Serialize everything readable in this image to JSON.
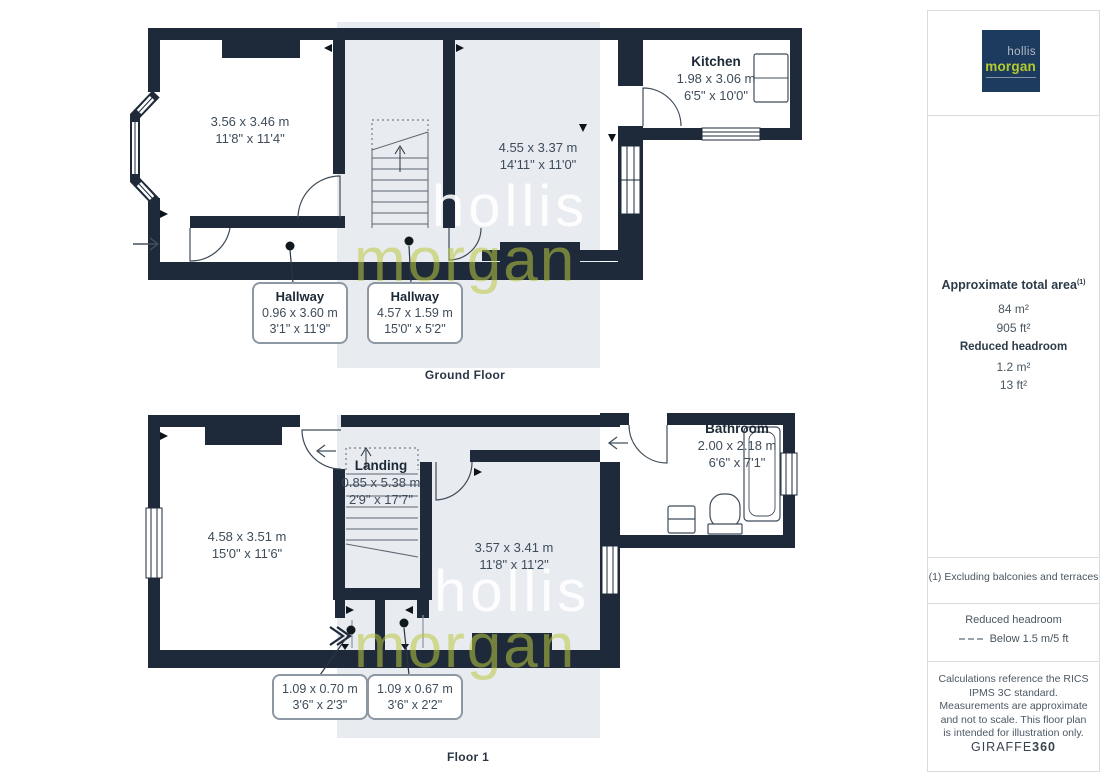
{
  "ground_floor": {
    "label": "Ground Floor",
    "rooms": [
      {
        "dims_m": "3.56 x 3.46 m",
        "dims_ft": "11'8\" x 11'4\""
      },
      {
        "name": "Kitchen",
        "dims_m": "1.98 x 3.06 m",
        "dims_ft": "6'5\" x 10'0\""
      },
      {
        "dims_m": "4.55 x 3.37 m",
        "dims_ft": "14'11\" x 11'0\""
      }
    ],
    "callouts": [
      {
        "name": "Hallway",
        "dims_m": "0.96 x 3.60 m",
        "dims_ft": "3'1\" x 11'9\""
      },
      {
        "name": "Hallway",
        "dims_m": "4.57 x 1.59 m",
        "dims_ft": "15'0\" x 5'2\""
      }
    ]
  },
  "floor_1": {
    "label": "Floor 1",
    "rooms": [
      {
        "dims_m": "4.58 x 3.51 m",
        "dims_ft": "15'0\" x 11'6\""
      },
      {
        "name": "Landing",
        "dims_m": "0.85 x 5.38 m",
        "dims_ft": "2'9\" x 17'7\""
      },
      {
        "dims_m": "3.57 x 3.41 m",
        "dims_ft": "11'8\" x 11'2\""
      },
      {
        "name": "Bathroom",
        "dims_m": "2.00 x 2.18 m",
        "dims_ft": "6'6\" x 7'1\""
      }
    ],
    "callouts": [
      {
        "dims_m": "1.09 x 0.70 m",
        "dims_ft": "3'6\" x 2'3\""
      },
      {
        "dims_m": "1.09 x 0.67 m",
        "dims_ft": "3'6\" x 2'2\""
      }
    ]
  },
  "watermark": {
    "line1": "hollis",
    "line2": "morgan"
  },
  "sidebar": {
    "logo": {
      "line1": "hollis",
      "line2": "morgan"
    },
    "area": {
      "title": "Approximate total area",
      "title_sup": "(1)",
      "total_m2": "84 m²",
      "total_ft2": "905 ft²",
      "reduced_title": "Reduced headroom",
      "reduced_m2": "1.2 m²",
      "reduced_ft2": "13 ft²"
    },
    "footnote": "(1) Excluding balconies and terraces",
    "legend": {
      "title": "Reduced headroom",
      "desc": "Below 1.5 m/5 ft"
    },
    "disclaimer": "Calculations reference the RICS IPMS 3C standard. Measurements are approximate and not to scale. This floor plan is intended for illustration only.",
    "brand": {
      "name": "GIRAFFE",
      "suffix": "360"
    }
  },
  "colors": {
    "wall": "#1e2a3a",
    "plan_background": "#e8ebf0",
    "logo_navy": "#1d3a5f",
    "logo_green": "#b4cb2d",
    "watermark_green": "#bac93e"
  }
}
